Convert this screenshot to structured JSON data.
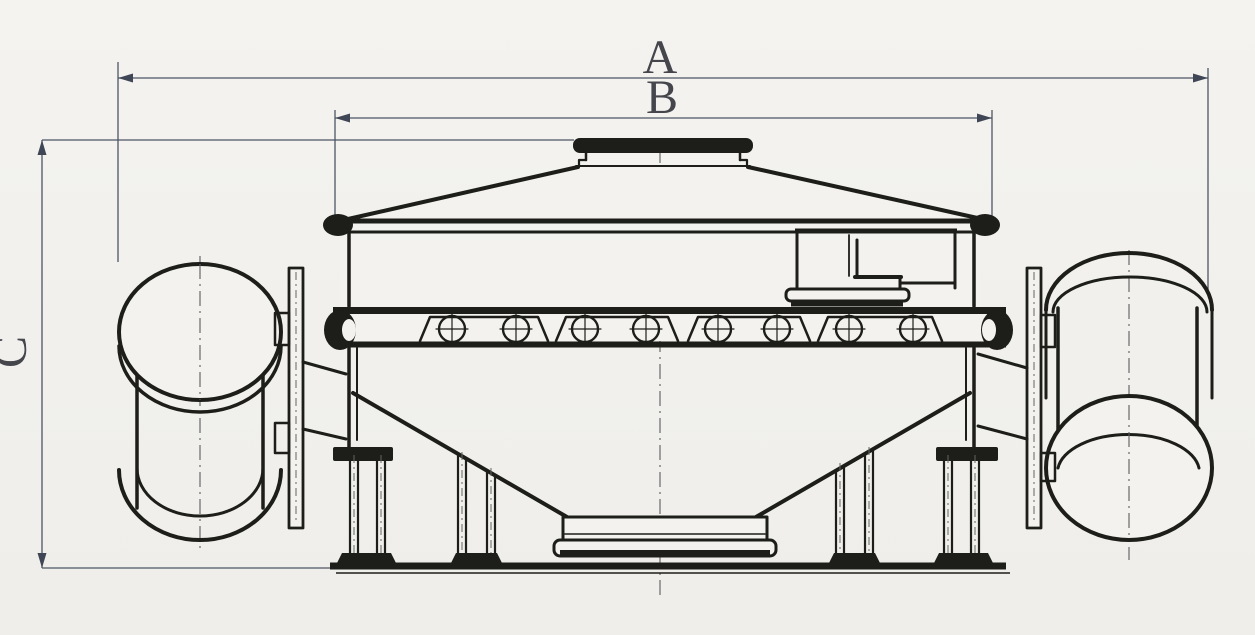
{
  "drawing": {
    "dimension_labels": {
      "overall_width": "A",
      "body_width": "B",
      "overall_height": "C"
    },
    "colors": {
      "paper": "#f3f2ee",
      "ink": "#1d1d1a",
      "dimension_line": "#4d5565",
      "label_text": "#45454c"
    }
  }
}
